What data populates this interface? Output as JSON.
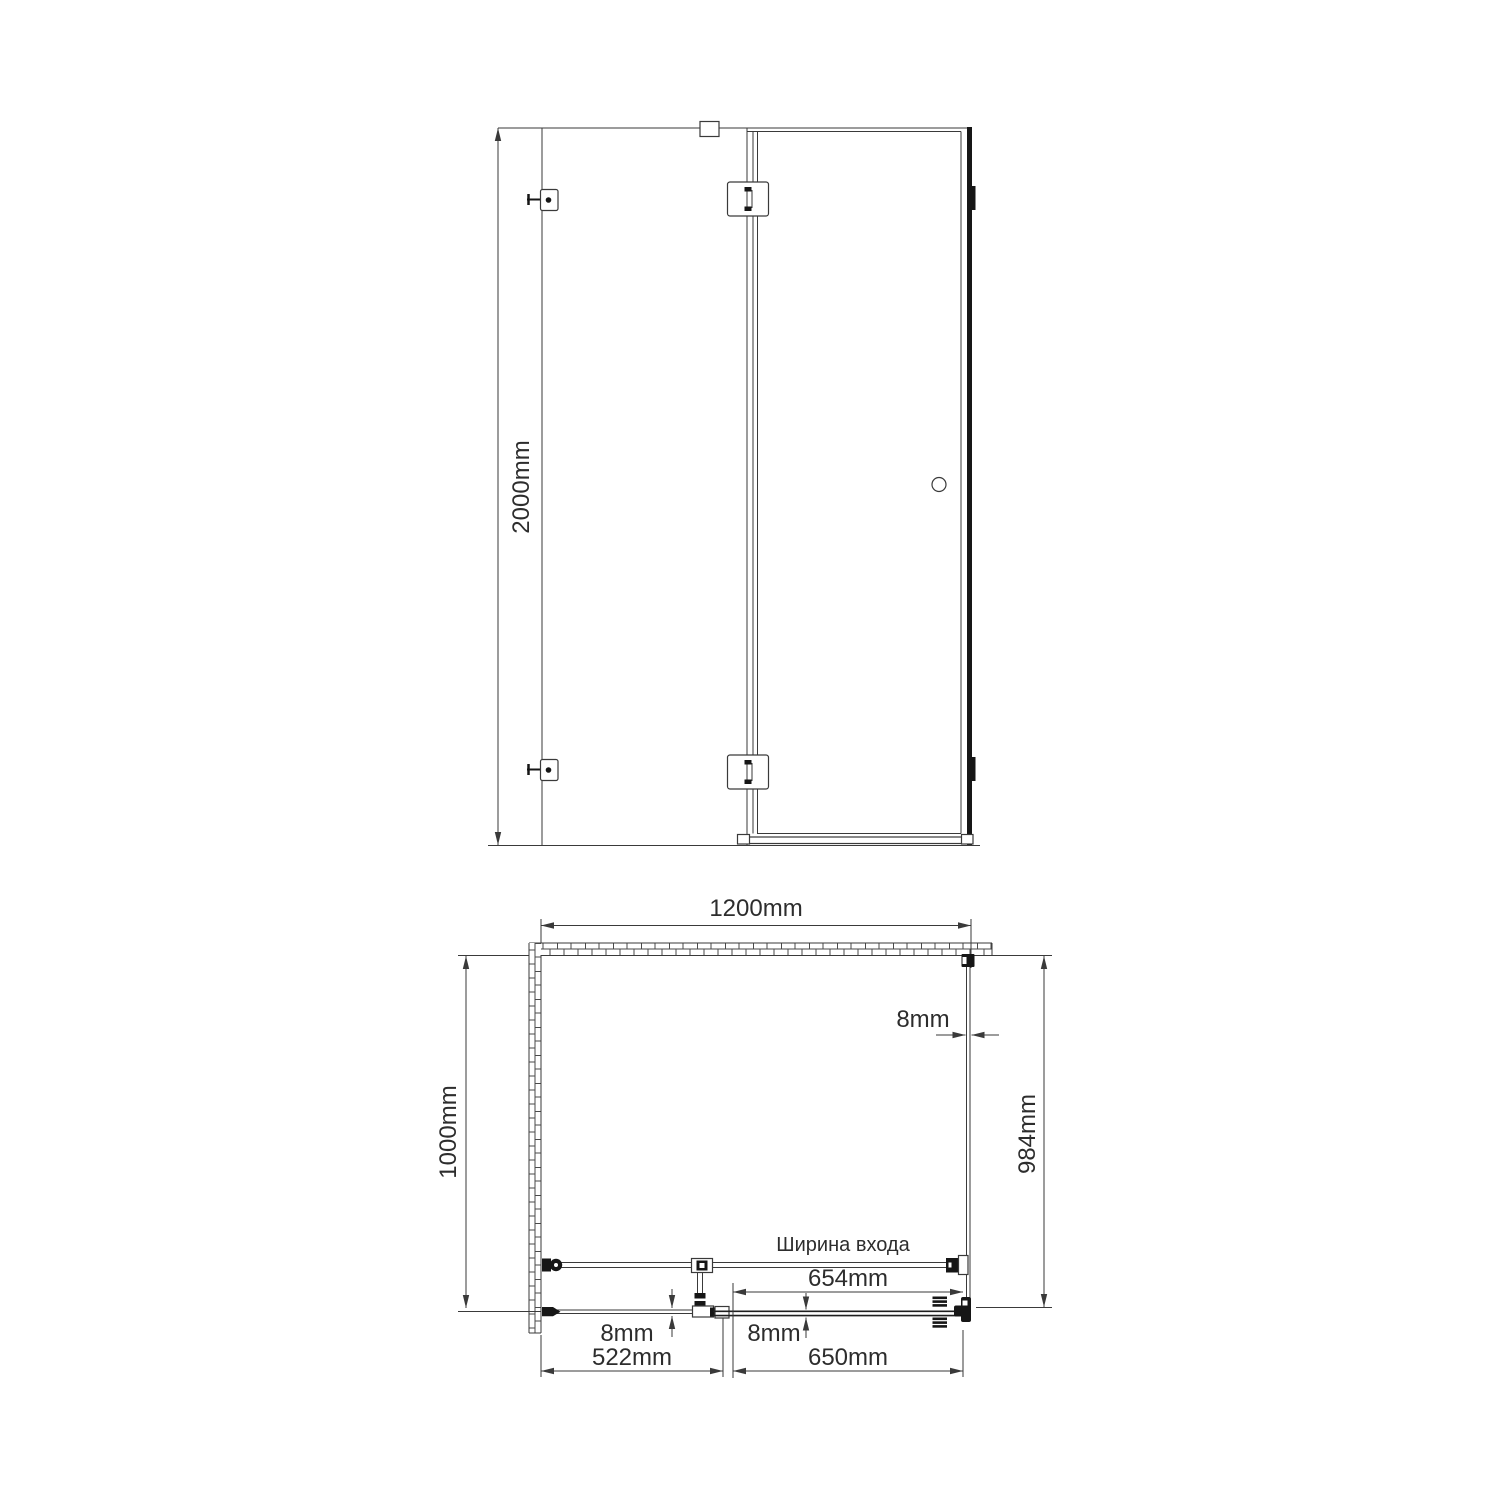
{
  "drawing": {
    "kind": "shower-enclosure-technical-drawing",
    "background": "#ffffff",
    "line_color": "#3a3a3a",
    "dark_fill": "#161616",
    "labels": {
      "height": "2000mm",
      "width": "1200mm",
      "depth": "1000mm",
      "side_panel": "984mm",
      "side_glass_thickness": "8mm",
      "entry_caption": "Ширина входа",
      "entry_width": "654mm",
      "fixed_glass_thickness": "8mm",
      "door_glass_thickness": "8mm",
      "fixed_section": "522mm",
      "door_section": "650mm"
    }
  }
}
